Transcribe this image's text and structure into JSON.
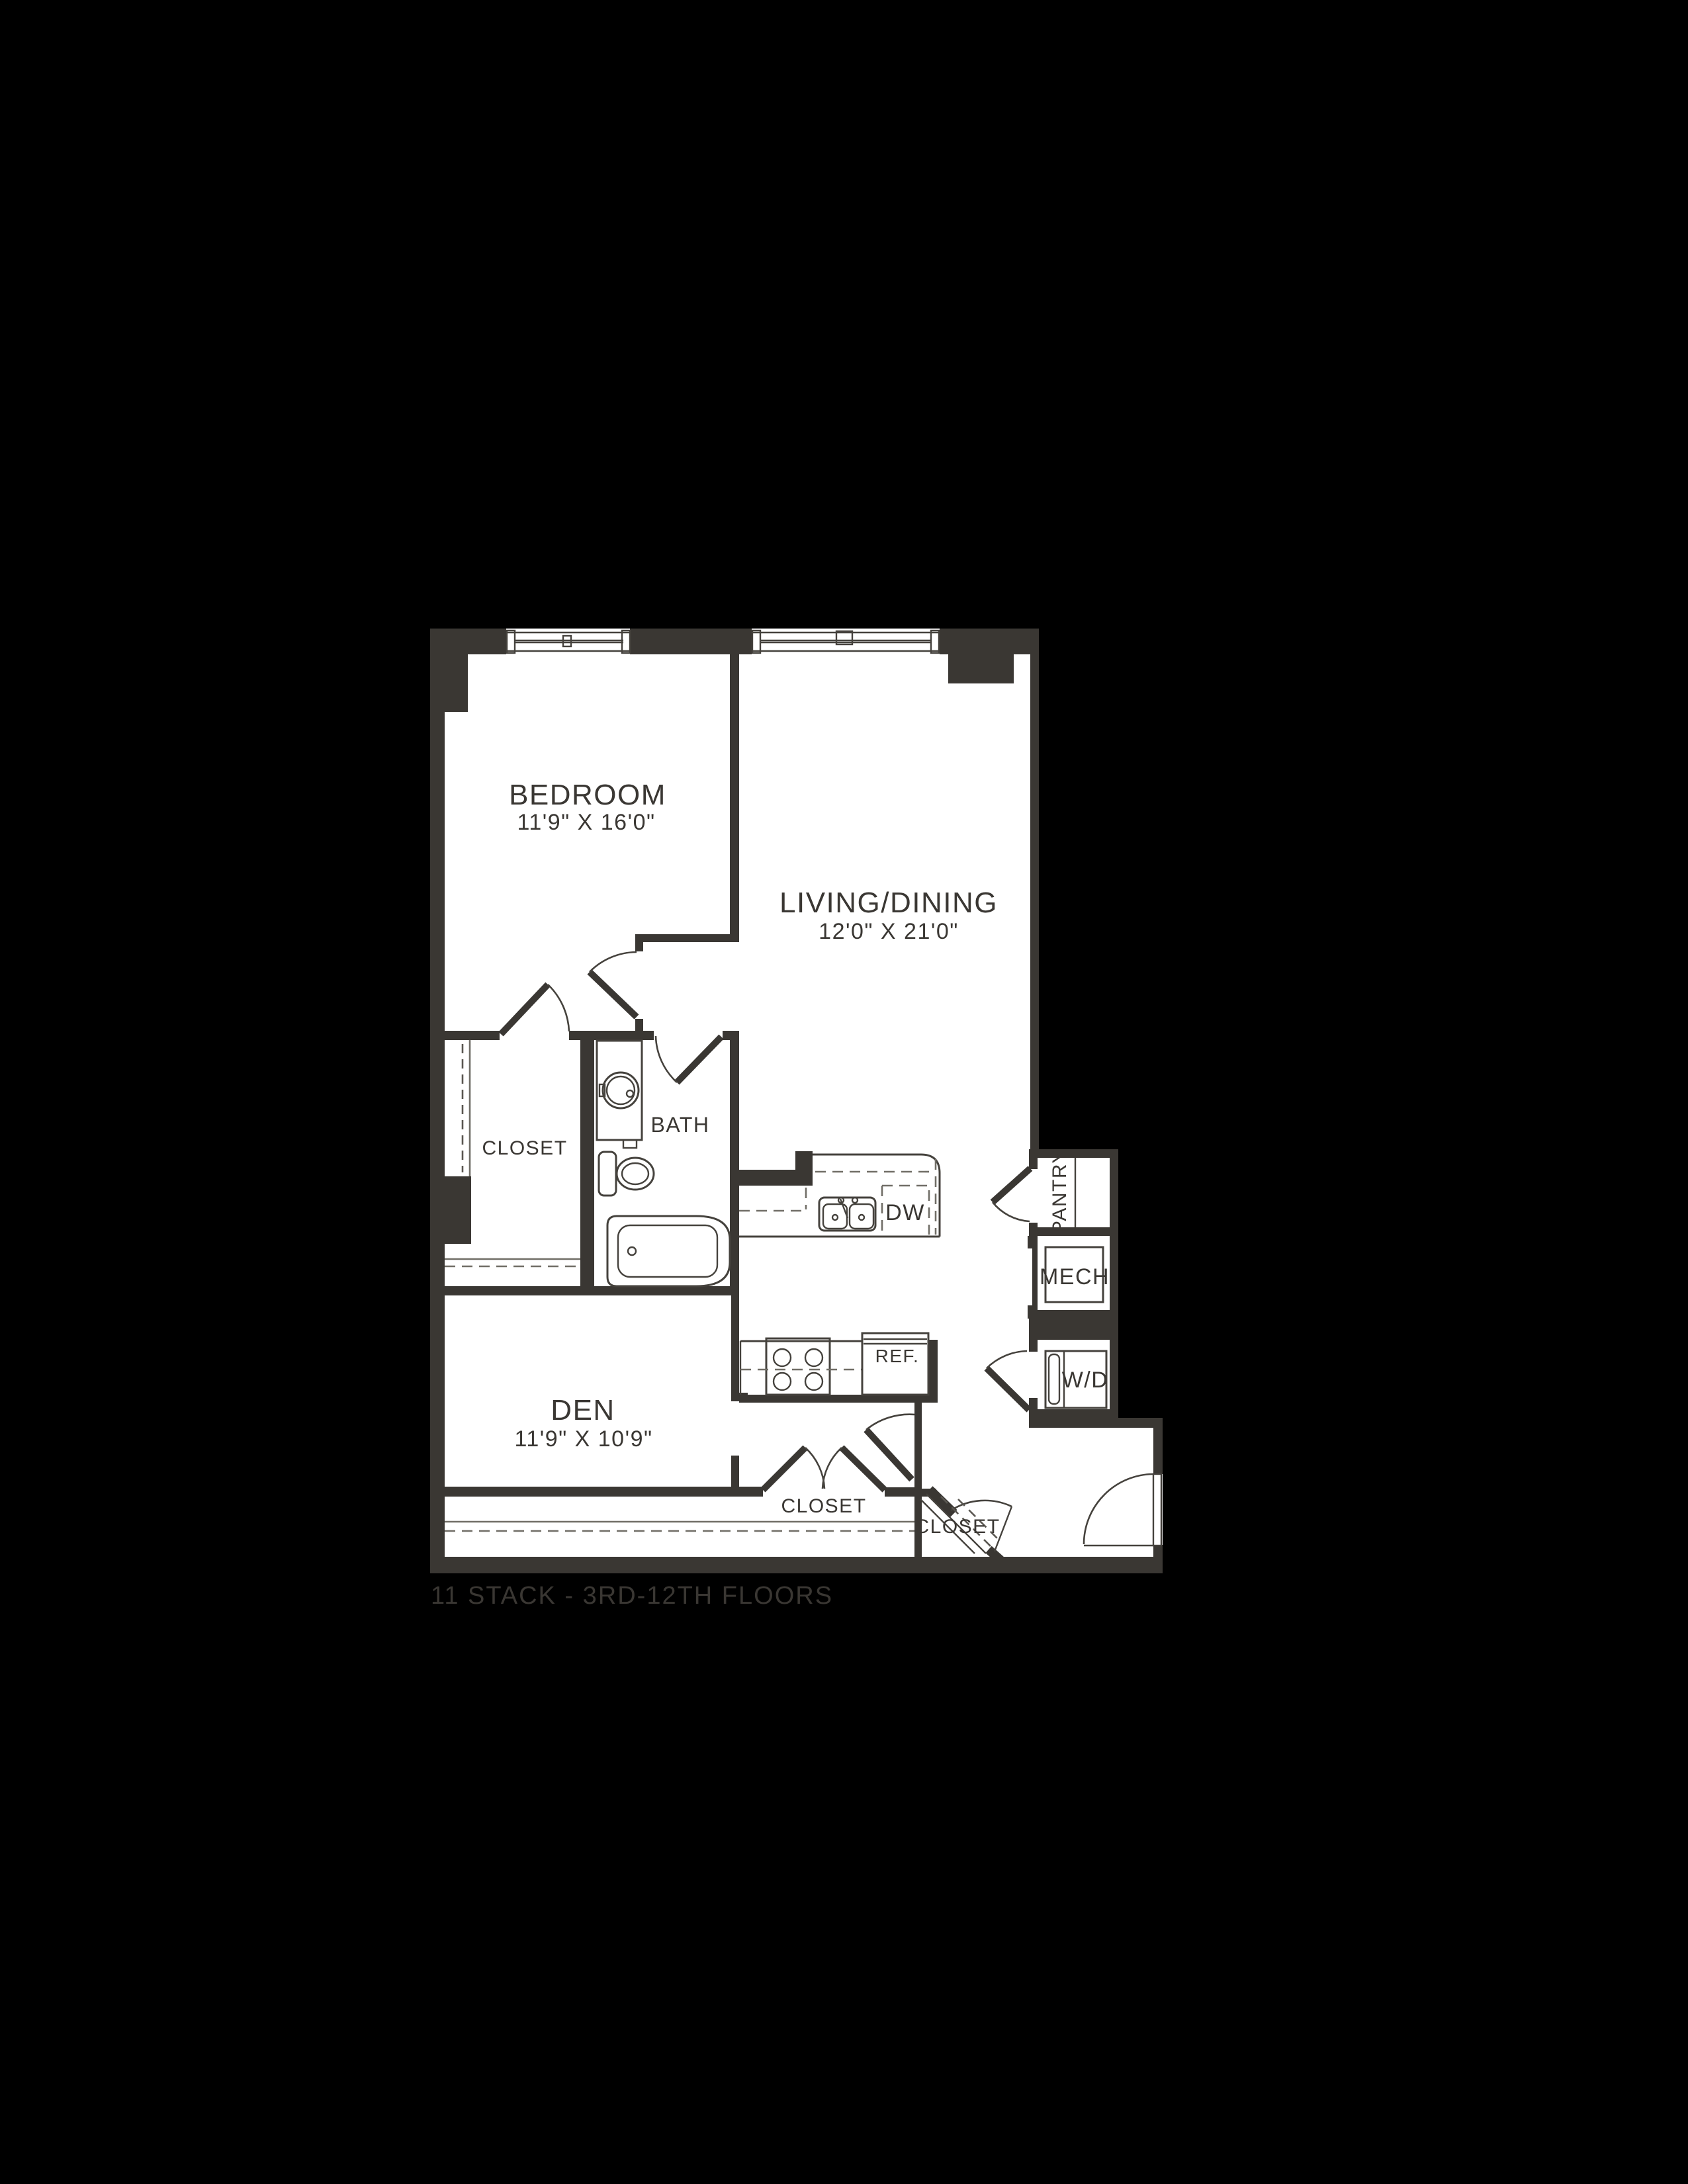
{
  "page": {
    "caption": "11 STACK - 3RD-12TH FLOORS"
  },
  "floorplan": {
    "colors": {
      "background": "#000000",
      "wall": "#3a3733",
      "floor": "#ffffff",
      "detail_line": "#716e67"
    },
    "rooms": {
      "bedroom": {
        "label": "BEDROOM",
        "dims": "11'9\" X 16'0\""
      },
      "living_dining": {
        "label": "LIVING/DINING",
        "dims": "12'0\" X 21'0\""
      },
      "den": {
        "label": "DEN",
        "dims": "11'9\" X 10'9\""
      },
      "bath": {
        "label": "BATH"
      },
      "bedroom_closet": {
        "label": "CLOSET"
      },
      "hall_closet": {
        "label": "CLOSET"
      },
      "entry_closet": {
        "label": "CLOSET"
      },
      "pantry": {
        "label": "PANTRY"
      },
      "mech": {
        "label": "MECH"
      },
      "washer_dryer": {
        "label": "W/D"
      }
    },
    "appliances": {
      "dishwasher": "DW",
      "refrigerator": "REF."
    }
  }
}
